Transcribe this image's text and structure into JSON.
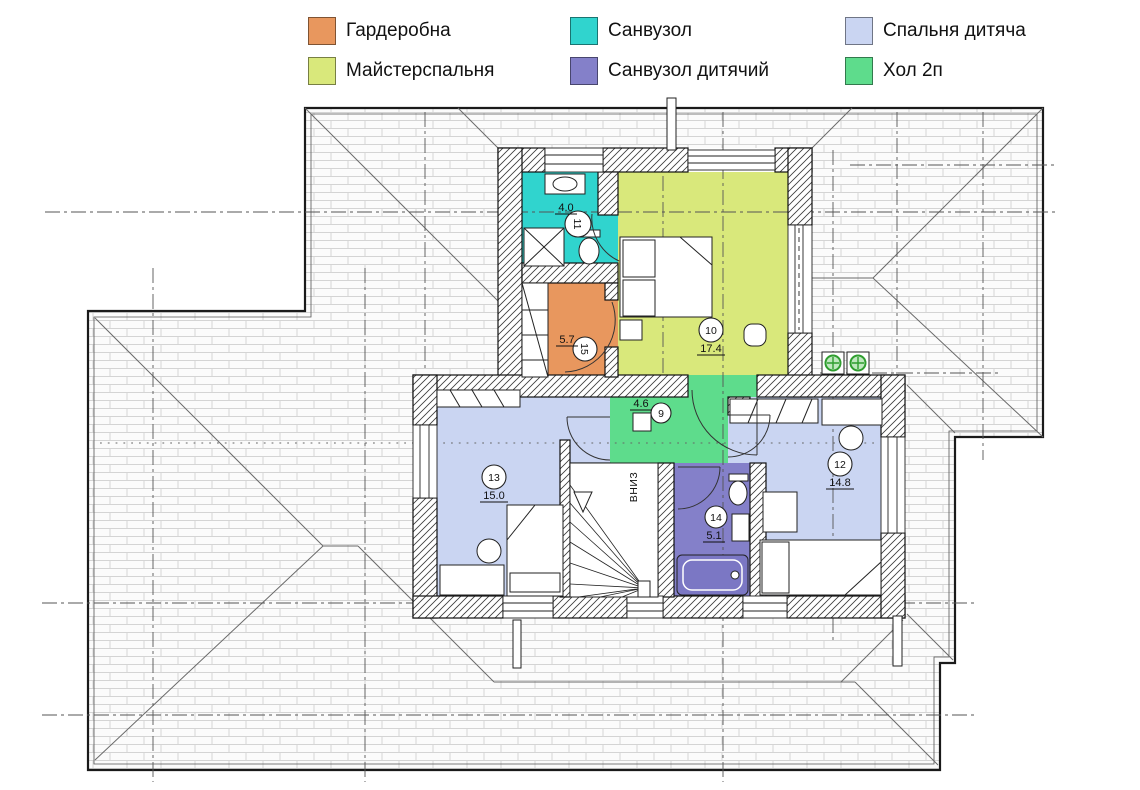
{
  "legend": {
    "items": [
      {
        "label": "Гардеробна",
        "color": "#E8975E"
      },
      {
        "label": "Майстерспальня",
        "color": "#D9E87B"
      },
      {
        "label": "Санвузол",
        "color": "#30D4CE"
      },
      {
        "label": "Санвузол дитячий",
        "color": "#8480C9"
      },
      {
        "label": "Спальня дитяча",
        "color": "#CAD5F2"
      },
      {
        "label": "Хол 2п",
        "color": "#5EDC8C"
      }
    ]
  },
  "plan": {
    "stairs_label": "ВНИЗ",
    "rooms": {
      "bathroom": {
        "number": "11",
        "area": "4.0",
        "name": "Санвузол",
        "color": "#30D4CE"
      },
      "wardrobe": {
        "number": "15",
        "area": "5.7",
        "name": "Гардеробна",
        "color": "#E8975E"
      },
      "master": {
        "number": "10",
        "area": "17.4",
        "name": "Майстерспальня",
        "color": "#D9E87B"
      },
      "hall": {
        "number": "9",
        "area": "4.6",
        "name": "Хол 2п",
        "color": "#5EDC8C"
      },
      "child_left": {
        "number": "13",
        "area": "15.0",
        "name": "Спальня дитяча",
        "color": "#CAD5F2"
      },
      "child_right": {
        "number": "12",
        "area": "14.8",
        "name": "Спальня дитяча",
        "color": "#CAD5F2"
      },
      "child_bathroom": {
        "number": "14",
        "area": "5.1",
        "name": "Санвузол дитячий",
        "color": "#8480C9"
      }
    }
  }
}
